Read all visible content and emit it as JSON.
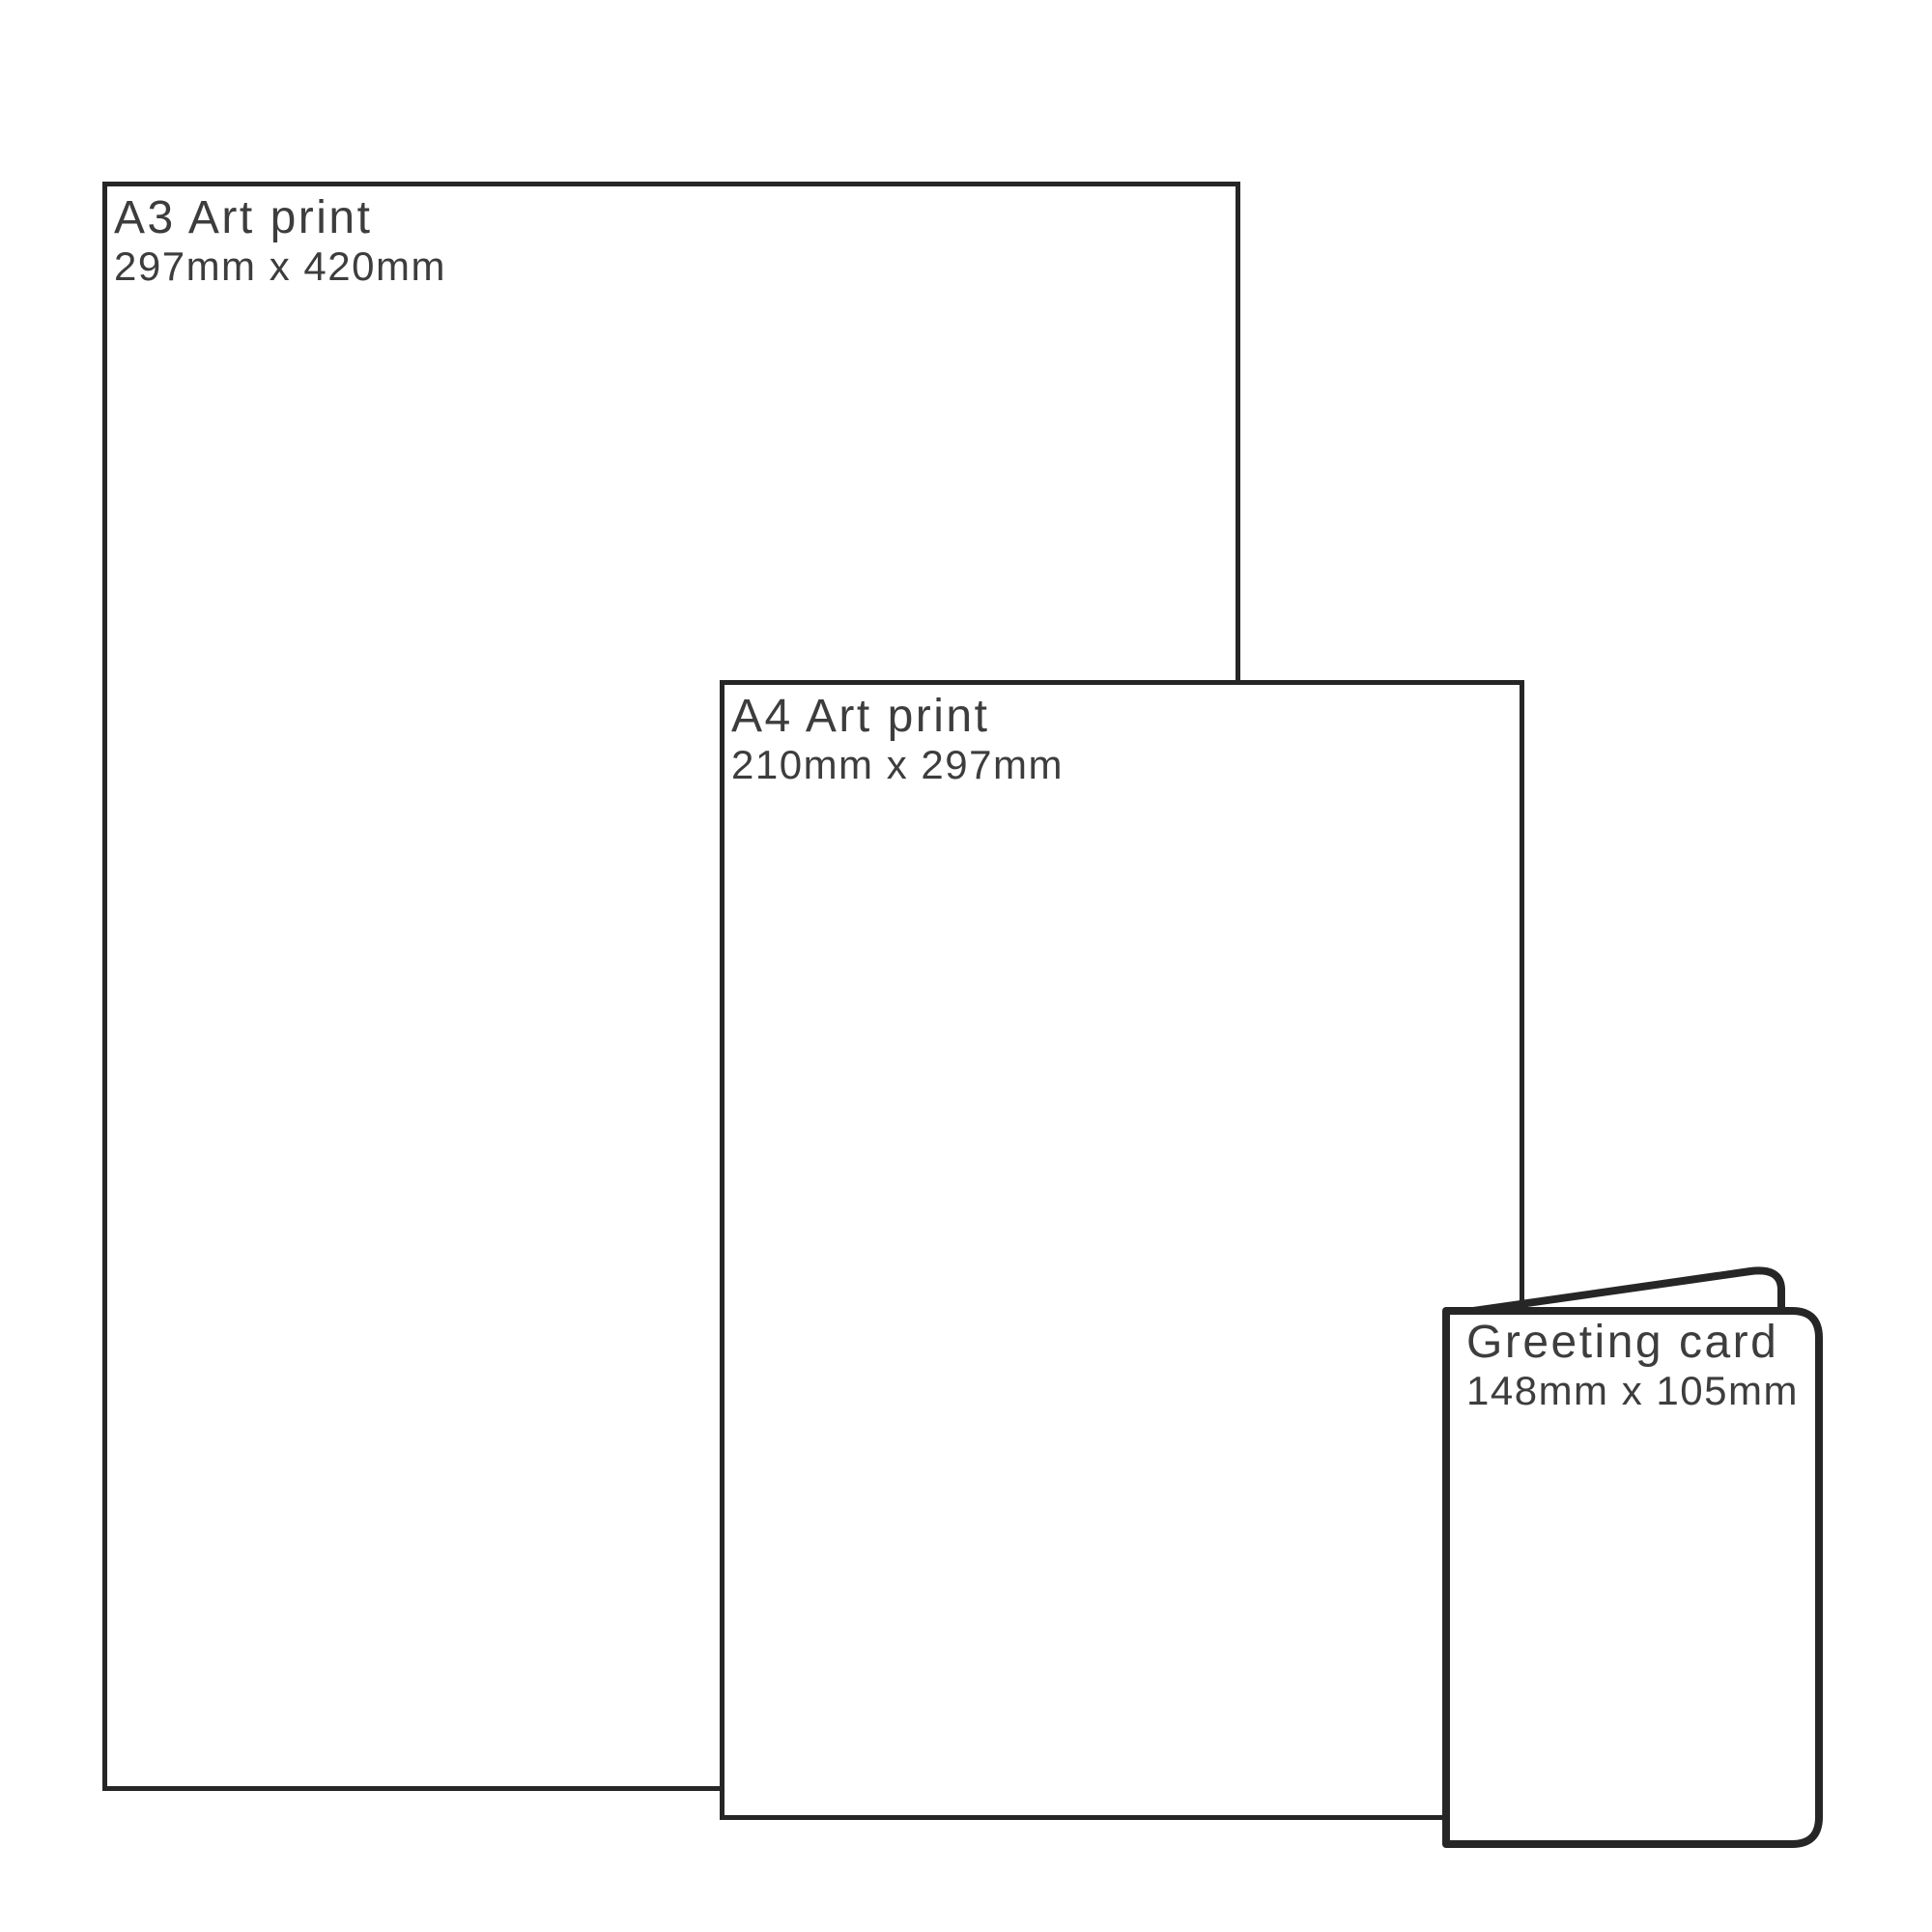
{
  "diagram": {
    "description": "Print size comparison diagram",
    "items": [
      {
        "id": "a3",
        "title": "A3 Art print",
        "dimensions": "297mm x 420mm"
      },
      {
        "id": "a4",
        "title": "A4 Art print",
        "dimensions": "210mm x 297mm"
      },
      {
        "id": "card",
        "title": "Greeting card",
        "dimensions": "148mm x 105mm"
      }
    ],
    "colors": {
      "background": "#ffffff",
      "outline": "#262626",
      "text": "#3d3d3d"
    }
  }
}
